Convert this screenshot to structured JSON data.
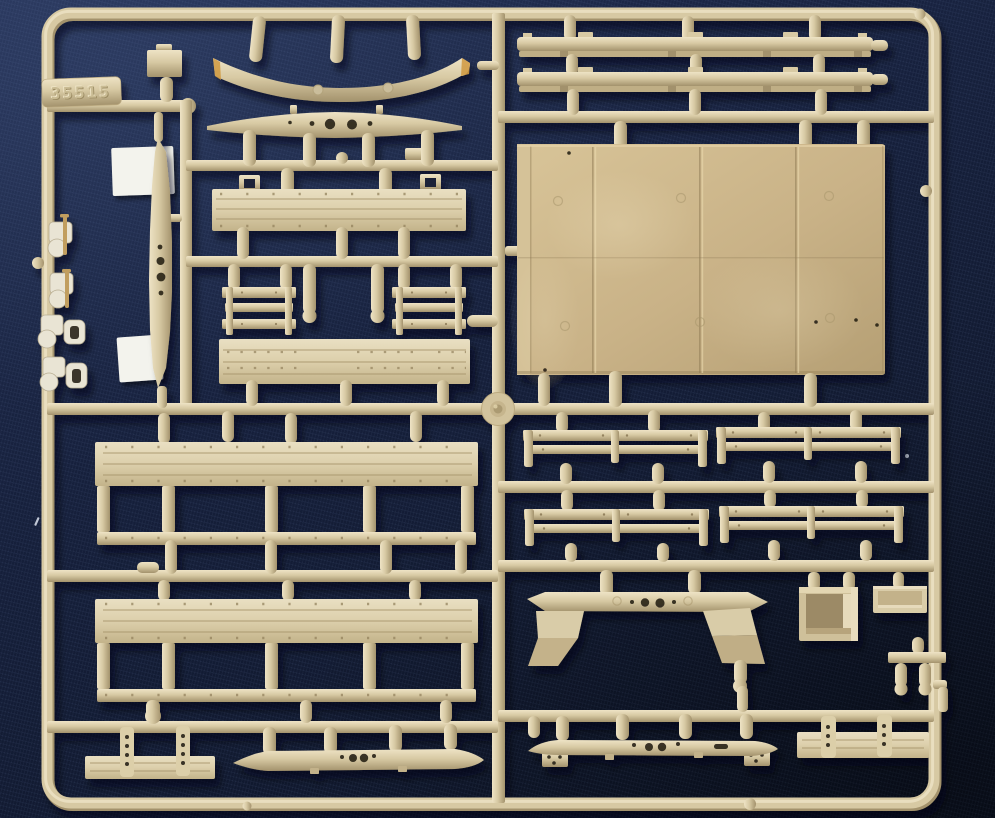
{
  "sprue": {
    "label": "35515"
  },
  "colors": {
    "bg_light": "#243155",
    "bg_base": "#16203c",
    "bg_deep": "#0b1222",
    "runner_hi": "#eee3c5",
    "runner_base": "#d7c9a3",
    "runner_lo": "#a3926c",
    "board_hi": "#e9dfc2",
    "board_base": "#dccfab",
    "board_lo": "#c3b38a",
    "panel_hi": "#d8c498",
    "panel_base": "#c9b287",
    "panel_lo": "#b59f74",
    "plank": "#a7956c",
    "rivet": "#94835e",
    "hole": "#221d12",
    "paper": "#f3f3ed",
    "orange": "#d0993f",
    "clip": "#e9e4d4",
    "rod": "#c19e5e",
    "lint": "#dde4f0",
    "speck_blue": "#8fd0ea"
  },
  "parts": {
    "labels": [
      "sprue-number-tag",
      "front-bumper",
      "cross-member-beam",
      "leaf-spring",
      "bed-side-board-upper",
      "bench-rail-pair",
      "bed-side-board-lower",
      "running-board-strips",
      "cargo-floor-panel",
      "side-rail-racks",
      "cargo-stake-side-panels",
      "fender-bracket",
      "storage-box",
      "tool-tray",
      "pin-tee",
      "end-plates",
      "chassis-cross-members",
      "clip-brackets",
      "tie-rods",
      "buckle-rings",
      "white-backing-cards"
    ]
  }
}
